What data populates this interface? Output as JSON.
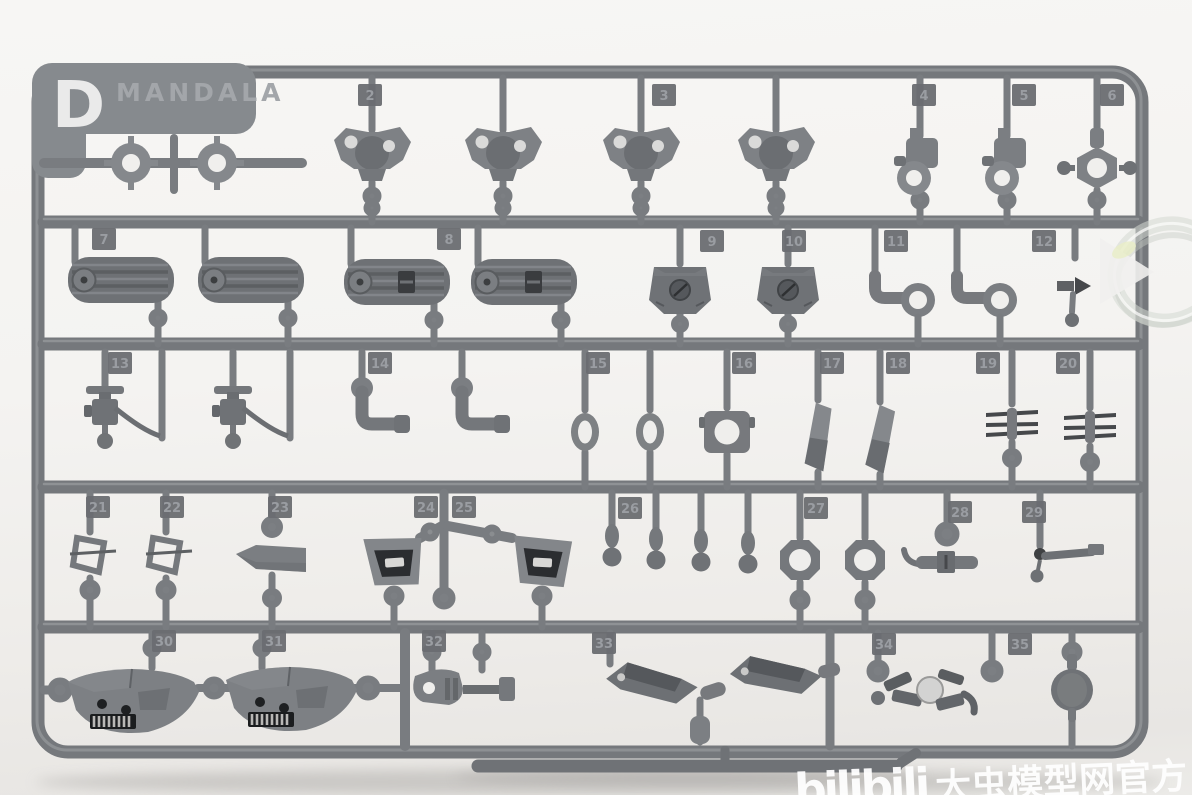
{
  "photo": {
    "subject": "gray injection-molded plastic model kit runner (sprue) with numbered parts",
    "background_color": "#f2f1ee",
    "plastic_color": "#75787c",
    "clear_part_color": "#d9ddd8"
  },
  "sprue": {
    "letter": "D",
    "brand": "MANDALA",
    "tags": [
      {
        "number": "2"
      },
      {
        "number": "3"
      },
      {
        "number": "4"
      },
      {
        "number": "5"
      },
      {
        "number": "6"
      },
      {
        "number": "7"
      },
      {
        "number": "8"
      },
      {
        "number": "9"
      },
      {
        "number": "10"
      },
      {
        "number": "11"
      },
      {
        "number": "12"
      },
      {
        "number": "13"
      },
      {
        "number": "14"
      },
      {
        "number": "15"
      },
      {
        "number": "16"
      },
      {
        "number": "17"
      },
      {
        "number": "18"
      },
      {
        "number": "19"
      },
      {
        "number": "20"
      },
      {
        "number": "21"
      },
      {
        "number": "22"
      },
      {
        "number": "23"
      },
      {
        "number": "24"
      },
      {
        "number": "25"
      },
      {
        "number": "26"
      },
      {
        "number": "27"
      },
      {
        "number": "28"
      },
      {
        "number": "29"
      },
      {
        "number": "30"
      },
      {
        "number": "31"
      },
      {
        "number": "32"
      },
      {
        "number": "33"
      },
      {
        "number": "34"
      },
      {
        "number": "35"
      }
    ]
  },
  "watermark": {
    "logo": "bilibili",
    "text": "大虫模型网官方",
    "color": "#ffffff"
  }
}
